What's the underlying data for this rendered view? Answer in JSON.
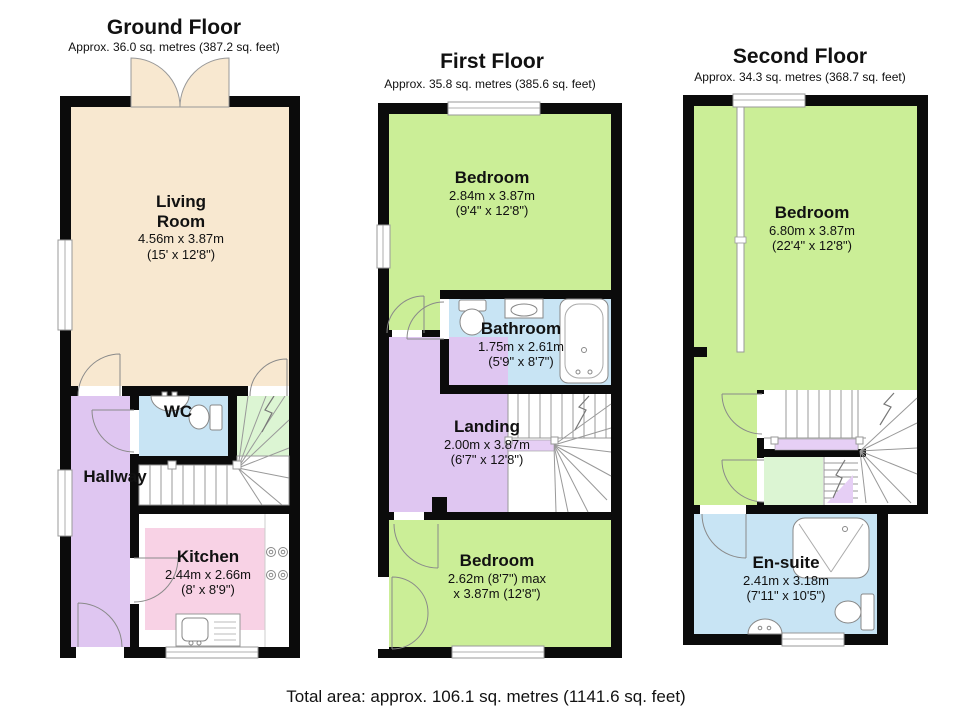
{
  "page": {
    "total_area": "Total area: approx. 106.1 sq. metres (1141.6 sq. feet)"
  },
  "colors": {
    "wall": "#0b0b0b",
    "living": "#f8e8d0",
    "bedroom": "#cbee97",
    "bathroom_blue": "#c8e4f4",
    "hallway": "#dfc6f1",
    "kitchen_pink": "#f8d2e5",
    "stair_green": "#dcf5d3",
    "half_landing": "#e6cff5"
  },
  "floors": {
    "ground": {
      "title": "Ground Floor",
      "subtitle": "Approx. 36.0 sq. metres (387.2 sq. feet)",
      "rooms": {
        "living": {
          "name": "Living Room",
          "metric": "4.56m x 3.87m",
          "imperial": "(15' x 12'8\")"
        },
        "wc": {
          "name": "WC"
        },
        "hallway": {
          "name": "Hallway"
        },
        "kitchen": {
          "name": "Kitchen",
          "metric": "2.44m x 2.66m",
          "imperial": "(8' x 8'9\")"
        }
      }
    },
    "first": {
      "title": "First Floor",
      "subtitle": "Approx. 35.8 sq. metres (385.6 sq. feet)",
      "rooms": {
        "bedroom_front": {
          "name": "Bedroom",
          "metric": "2.84m x 3.87m",
          "imperial": "(9'4\" x 12'8\")"
        },
        "bathroom": {
          "name": "Bathroom",
          "metric": "1.75m x 2.61m",
          "imperial": "(5'9\" x 8'7\")"
        },
        "landing": {
          "name": "Landing",
          "metric": "2.00m x 3.87m",
          "imperial": "(6'7\" x 12'8\")"
        },
        "bedroom_back": {
          "name": "Bedroom",
          "metric": "2.62m (8'7\") max",
          "imperial": "x 3.87m (12'8\")"
        }
      }
    },
    "second": {
      "title": "Second Floor",
      "subtitle": "Approx. 34.3 sq. metres (368.7 sq. feet)",
      "rooms": {
        "bedroom": {
          "name": "Bedroom",
          "metric": "6.80m x 3.87m",
          "imperial": "(22'4\" x 12'8\")"
        },
        "ensuite": {
          "name": "En-suite",
          "metric": "2.41m x 3.18m",
          "imperial": "(7'11\" x 10'5\")"
        }
      }
    }
  }
}
